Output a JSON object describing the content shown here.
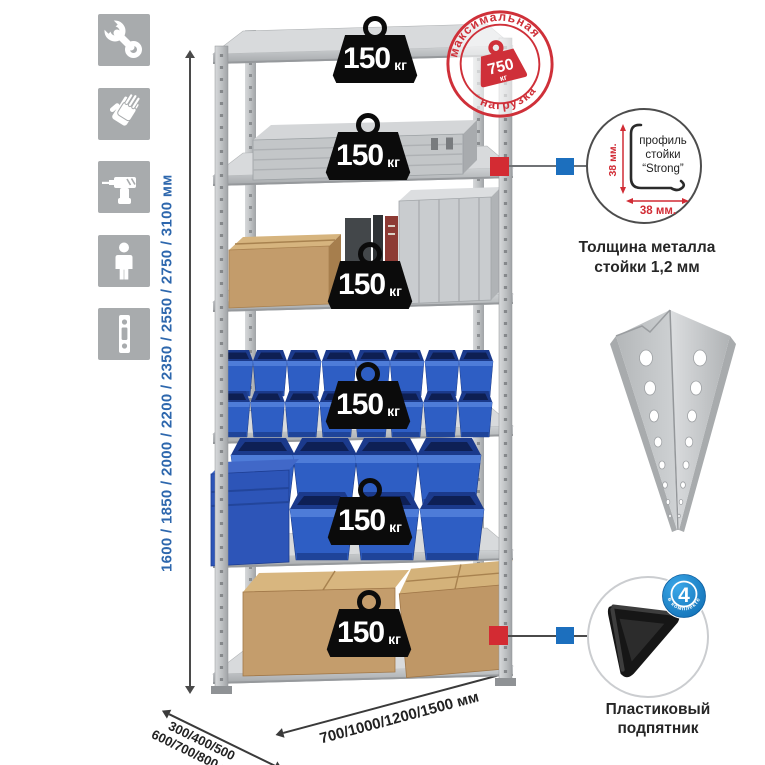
{
  "dimensions": {
    "height": "1600 / 1850 / 2000 / 2200 / 2350 / 2550 / 2750 / 3100 мм",
    "depth_line1": "300/400/500",
    "depth_line2": "600/700/800 мм",
    "width": "700/1000/1200/1500 мм"
  },
  "badges": [
    {
      "value": "150",
      "unit": "кг"
    },
    {
      "value": "150",
      "unit": "кг"
    },
    {
      "value": "150",
      "unit": "кг"
    },
    {
      "value": "150",
      "unit": "кг"
    },
    {
      "value": "150",
      "unit": "кг"
    },
    {
      "value": "150",
      "unit": "кг"
    }
  ],
  "stamp": {
    "arc_top": "максимальная",
    "arc_bottom": "нагрузка",
    "value": "750",
    "unit": "кг"
  },
  "profile_detail": {
    "line1": "профиль",
    "line2": "стойки",
    "line3": "“Strong”",
    "dim_vertical": "38 мм.",
    "dim_horizontal": "38 мм.",
    "caption": "Толщина металла стойки 1,2 мм"
  },
  "foot_detail": {
    "badge_value": "4",
    "badge_ring_text": "в комплекте",
    "caption": "Пластиковый подпятник"
  },
  "icons": [
    "wrench-icon",
    "gloves-icon",
    "drill-icon",
    "person-icon",
    "post-profile-icon"
  ],
  "colors": {
    "stamp_red": "#cf3039",
    "connector_red": "#d32b33",
    "connector_blue": "#1c6fbe",
    "bin_blue": "#2e5ec4",
    "dim_text_blue": "#2d67ad",
    "icon_gray": "#a8abad"
  }
}
